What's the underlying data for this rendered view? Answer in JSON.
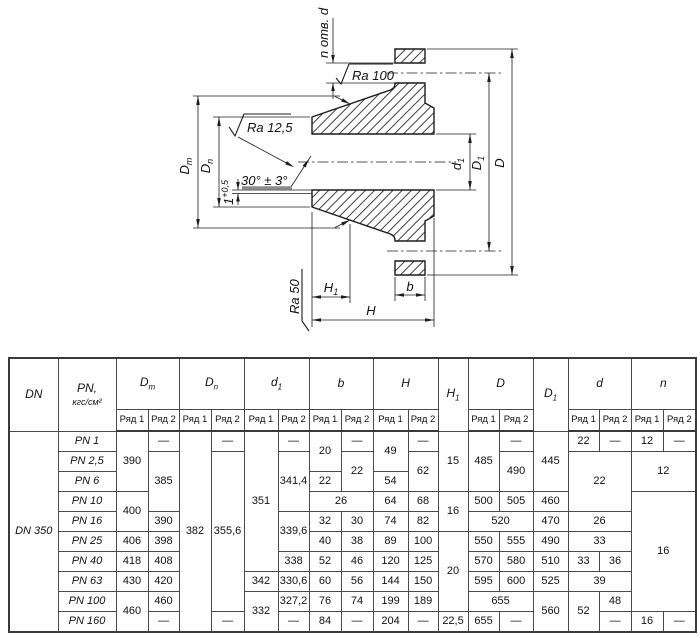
{
  "drawing": {
    "labels": {
      "n_holes": "n отв. d",
      "ra100": "Ra 100",
      "ra125": "Ra 12,5",
      "ra50": "Ra 50",
      "angle": "30° ± 3°",
      "tol_base": "1",
      "tol_sup": "+0,5",
      "Dm_base": "D",
      "Dm_sub": "m",
      "Dn_base": "D",
      "Dn_sub": "n",
      "d1_base": "d",
      "d1_sub": "1",
      "D1_base": "D",
      "D1_sub": "1",
      "D_label": "D",
      "H_label": "H",
      "H1_base": "H",
      "H1_sub": "1",
      "b_label": "b"
    },
    "line_color": "#1c1c1c",
    "gray_bar_color": "#8c8c8c"
  },
  "table": {
    "columns_px": [
      49,
      58,
      32,
      31,
      32,
      33,
      34,
      31,
      32,
      32,
      35,
      30,
      30,
      31,
      34,
      35,
      31,
      32,
      32,
      33
    ],
    "header": {
      "row1": [
        {
          "t": "DN",
          "i": 1,
          "rs": 2
        },
        {
          "t": "PN,",
          "unit": "кгс/см²",
          "i": 1,
          "rs": 2
        },
        {
          "t": "D",
          "sub": "m",
          "i": 1,
          "cs": 2
        },
        {
          "t": "D",
          "sub": "n",
          "i": 1,
          "cs": 2
        },
        {
          "t": "d",
          "sub": "1",
          "i": 1,
          "cs": 2
        },
        {
          "t": "b",
          "i": 1,
          "cs": 2
        },
        {
          "t": "H",
          "i": 1,
          "cs": 2
        },
        {
          "t": "H",
          "sub": "1",
          "i": 1,
          "rs": 2
        },
        {
          "t": "D",
          "i": 1,
          "cs": 2
        },
        {
          "t": "D",
          "sub": "1",
          "i": 1,
          "rs": 2
        },
        {
          "t": "d",
          "i": 1,
          "cs": 2
        },
        {
          "t": "n",
          "i": 1,
          "cs": 2
        }
      ],
      "row2_label_1": "Ряд 1",
      "row2_label_2": "Ряд 2",
      "row2_pairs": 8
    },
    "body": [
      [
        {
          "v": "DN 350",
          "rs": 10,
          "i": 1,
          "name": "dn-cell"
        },
        {
          "v": "PN 1",
          "i": 1,
          "name": "row-label"
        },
        {
          "v": "390",
          "rs": 3
        },
        {
          "v": "—"
        },
        {
          "v": "382",
          "rs": 10
        },
        {
          "v": "—"
        },
        {
          "v": "351",
          "rs": 7
        },
        {
          "v": "—"
        },
        {
          "v": "20",
          "rs": 2
        },
        {
          "v": "—"
        },
        {
          "v": "49",
          "rs": 2
        },
        {
          "v": "—"
        },
        {
          "v": "15",
          "rs": 3
        },
        {
          "v": "485",
          "rs": 3
        },
        {
          "v": "—"
        },
        {
          "v": "445",
          "rs": 3
        },
        {
          "v": "22"
        },
        {
          "v": "—"
        },
        {
          "v": "12"
        },
        {
          "v": "—"
        }
      ],
      [
        {
          "v": "PN 2,5",
          "i": 1,
          "name": "row-label"
        },
        {
          "v": "385",
          "rs": 3
        },
        {
          "v": "355,6",
          "rs": 8
        },
        {
          "v": "341,4",
          "rs": 3
        },
        {
          "v": "22",
          "rs": 2
        },
        {
          "v": "62",
          "rs": 2
        },
        {
          "v": "490",
          "rs": 2
        },
        {
          "v": "22",
          "rs": 3,
          "cs": 2
        },
        {
          "v": "12",
          "rs": 2,
          "cs": 2
        }
      ],
      [
        {
          "v": "PN 6",
          "i": 1,
          "name": "row-label"
        },
        {
          "v": "22"
        },
        {
          "v": "54"
        }
      ],
      [
        {
          "v": "PN 10",
          "i": 1,
          "name": "row-label"
        },
        {
          "v": "400",
          "rs": 2
        },
        {
          "v": "26",
          "cs": 2
        },
        {
          "v": "64"
        },
        {
          "v": "68"
        },
        {
          "v": "16",
          "rs": 2
        },
        {
          "v": "500"
        },
        {
          "v": "505"
        },
        {
          "v": "460"
        },
        {
          "v": "16",
          "rs": 6,
          "cs": 2
        }
      ],
      [
        {
          "v": "PN 16",
          "i": 1,
          "name": "row-label"
        },
        {
          "v": "390"
        },
        {
          "v": "339,6",
          "rs": 2
        },
        {
          "v": "32"
        },
        {
          "v": "30"
        },
        {
          "v": "74"
        },
        {
          "v": "82"
        },
        {
          "v": "520",
          "cs": 2
        },
        {
          "v": "470"
        },
        {
          "v": "26",
          "cs": 2
        }
      ],
      [
        {
          "v": "PN 25",
          "i": 1,
          "name": "row-label"
        },
        {
          "v": "406"
        },
        {
          "v": "398"
        },
        {
          "v": "40"
        },
        {
          "v": "38"
        },
        {
          "v": "89"
        },
        {
          "v": "100"
        },
        {
          "v": "20",
          "rs": 4
        },
        {
          "v": "550"
        },
        {
          "v": "555"
        },
        {
          "v": "490"
        },
        {
          "v": "33",
          "cs": 2
        }
      ],
      [
        {
          "v": "PN 40",
          "i": 1,
          "name": "row-label"
        },
        {
          "v": "418"
        },
        {
          "v": "408"
        },
        {
          "v": "338"
        },
        {
          "v": "52"
        },
        {
          "v": "46"
        },
        {
          "v": "120"
        },
        {
          "v": "125"
        },
        {
          "v": "570"
        },
        {
          "v": "580"
        },
        {
          "v": "510"
        },
        {
          "v": "33"
        },
        {
          "v": "36"
        }
      ],
      [
        {
          "v": "PN 63",
          "i": 1,
          "name": "row-label"
        },
        {
          "v": "430"
        },
        {
          "v": "420"
        },
        {
          "v": "342"
        },
        {
          "v": "330,6"
        },
        {
          "v": "60"
        },
        {
          "v": "56"
        },
        {
          "v": "144"
        },
        {
          "v": "150"
        },
        {
          "v": "595"
        },
        {
          "v": "600"
        },
        {
          "v": "525"
        },
        {
          "v": "39",
          "cs": 2
        }
      ],
      [
        {
          "v": "PN 100",
          "i": 1,
          "name": "row-label"
        },
        {
          "v": "460",
          "rs": 2
        },
        {
          "v": "460"
        },
        {
          "v": "332",
          "rs": 2
        },
        {
          "v": "327,2"
        },
        {
          "v": "76"
        },
        {
          "v": "74"
        },
        {
          "v": "199"
        },
        {
          "v": "189"
        },
        {
          "v": "655",
          "cs": 2
        },
        {
          "v": "560",
          "rs": 2
        },
        {
          "v": "52",
          "rs": 2
        },
        {
          "v": "48"
        }
      ],
      [
        {
          "v": "PN 160",
          "i": 1,
          "name": "row-label"
        },
        {
          "v": "—"
        },
        {
          "v": "—"
        },
        {
          "v": "—"
        },
        {
          "v": "84"
        },
        {
          "v": "—"
        },
        {
          "v": "204"
        },
        {
          "v": "—"
        },
        {
          "v": "22,5"
        },
        {
          "v": "655"
        },
        {
          "v": "—"
        },
        {
          "v": "—"
        },
        {
          "v": "16"
        },
        {
          "v": "—"
        }
      ]
    ]
  }
}
